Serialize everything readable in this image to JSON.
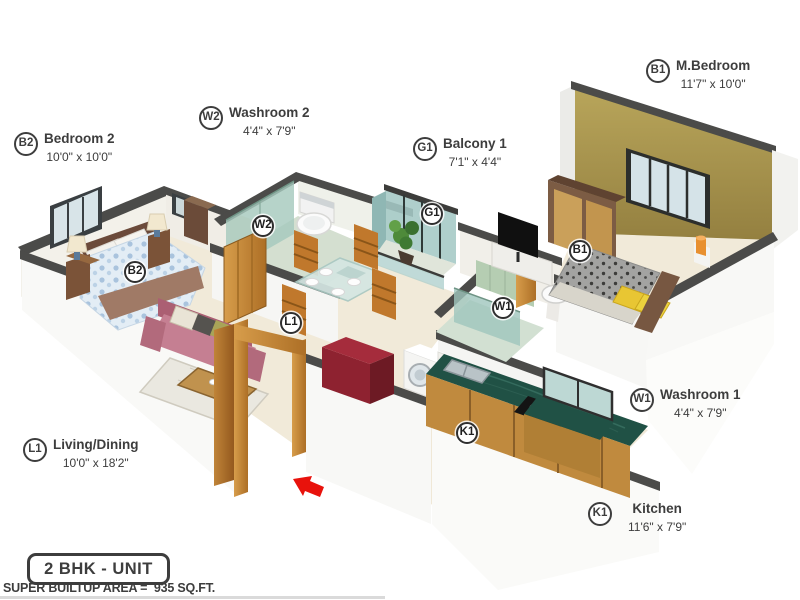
{
  "legend": {
    "unit": "2 BHK - UNIT",
    "area": "SUPER BUILTUP AREA =  935 SQ.FT."
  },
  "rooms": [
    {
      "code": "B2",
      "name": "Bedroom 2",
      "dims": "10'0\" x 10'0\""
    },
    {
      "code": "W2",
      "name": "Washroom 2",
      "dims": "4'4\" x 7'9\""
    },
    {
      "code": "G1",
      "name": "Balcony 1",
      "dims": "7'1\" x 4'4\""
    },
    {
      "code": "B1",
      "name": "M.Bedroom",
      "dims": "11'7\" x 10'0\""
    },
    {
      "code": "W1",
      "name": "Washroom 1",
      "dims": "4'4\" x 7'9\""
    },
    {
      "code": "K1",
      "name": "Kitchen",
      "dims": "11'6\" x 7'9\""
    },
    {
      "code": "L1",
      "name": "Living/Dining",
      "dims": "10'0\" x 18'2\""
    }
  ],
  "colors": {
    "accent_wall_olive": "#b3a055",
    "wall_cap_gray": "#4b4b49",
    "floor_cream": "#f1ead9",
    "granite_counter_green": "#205145",
    "cabinet_wood": "#c08a3e",
    "sofa_mauve": "#c57f92",
    "bed_duvet_blue": "#dce9f2",
    "bathroom_glass_teal": "#a6c9bd",
    "red_cabinet": "#8e2230",
    "entry_arrow_red": "#e8120c",
    "badge_border": "#3d3d3d"
  }
}
